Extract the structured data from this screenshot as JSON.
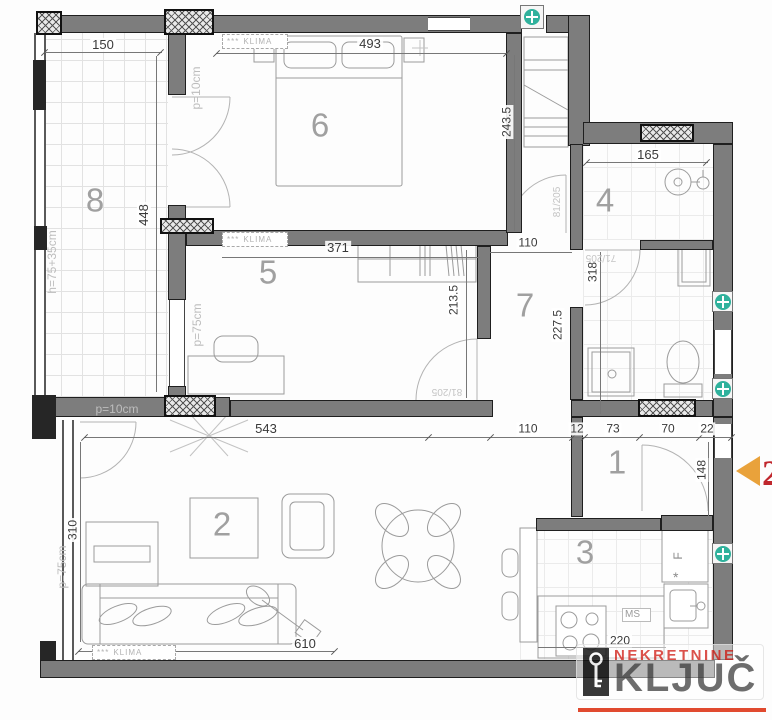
{
  "colors": {
    "wall": "#7d7d7d",
    "teal": "#2fb19c",
    "arrow": "#e9a23b",
    "marker_red": "#c0272d",
    "logo_red": "#d6342c",
    "logo_gray": "#555555",
    "dim": "#3a3a3a",
    "room": "#a0a0a0"
  },
  "rooms": {
    "terrace": "8",
    "bedroom": "6",
    "bathroom4": "4",
    "office": "5",
    "hall": "7",
    "living": "2",
    "entry": "1",
    "kitchen": "3"
  },
  "dims": {
    "d150": "150",
    "d448": "448",
    "h_parapet": "h=75+35cm",
    "d493": "493",
    "d243": "243.5",
    "p10": "p=10cm",
    "d165": "165",
    "d371": "371",
    "p75": "p=75cm",
    "d213": "213.5",
    "d110": "110",
    "d318": "318",
    "d227": "227.5",
    "d543": "543",
    "d310": "310",
    "d610": "610",
    "d12": "12",
    "d73": "73",
    "d70": "70",
    "d22": "22",
    "d148": "148",
    "d220": "220"
  },
  "doors": {
    "d81": "81/205",
    "d71": "71/205"
  },
  "klima": {
    "stars": "***",
    "label": "KLIMA"
  },
  "kitchen": {
    "ms": "MS",
    "fridge": "F",
    "freezer": "*"
  },
  "logo": {
    "top": "NEKRETNINE",
    "main": "KLJUČ"
  },
  "marker": {
    "value": "2"
  }
}
